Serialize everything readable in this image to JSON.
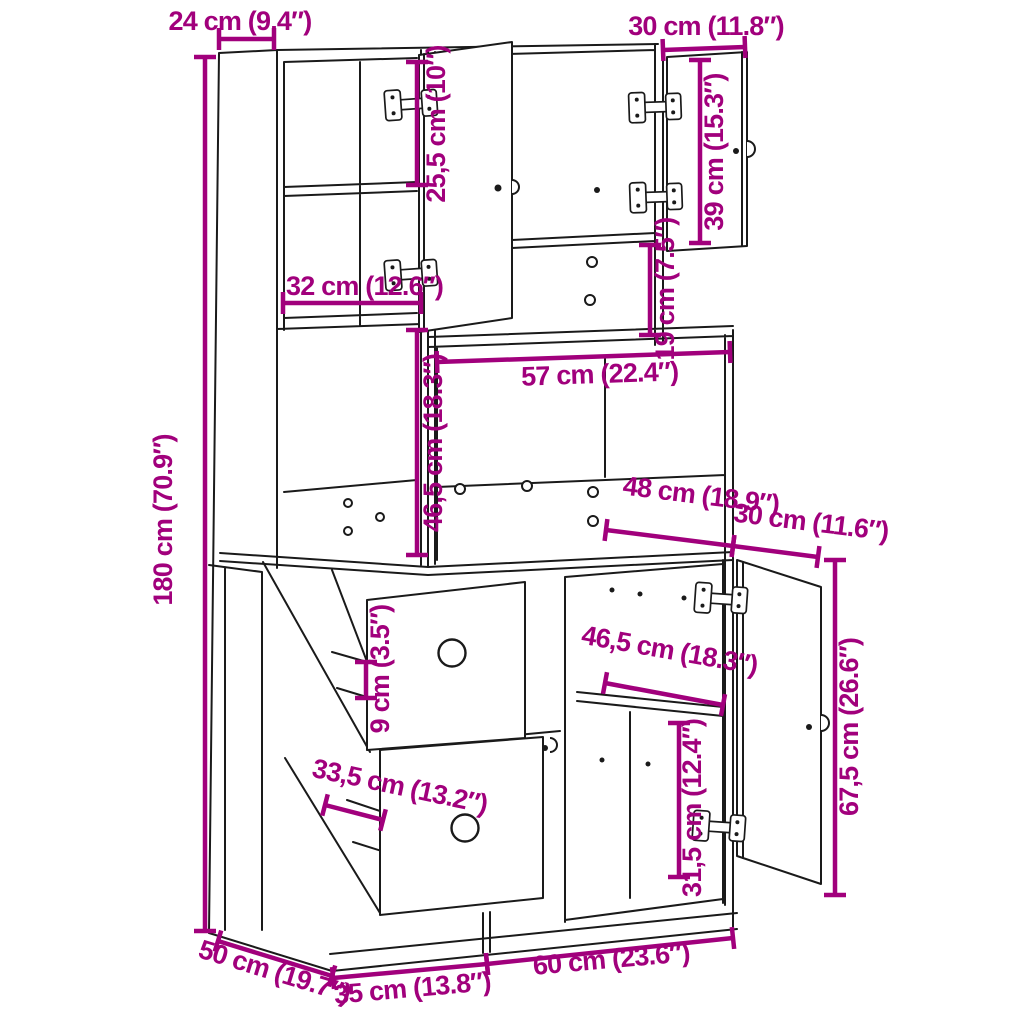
{
  "diagram": {
    "kind": "furniture dimension drawing",
    "subject": "kitchen cabinet with open doors, hinges and shelves"
  },
  "colors": {
    "dimension_accent": "#A1007C",
    "outline": "#1A1A1A",
    "background": "#FFFFFF"
  },
  "dimensions": [
    {
      "id": "width_top_side",
      "label": "24 cm (9.4″)"
    },
    {
      "id": "width_top_right_door",
      "label": "30 cm (11.8″)"
    },
    {
      "id": "height_top_compartment",
      "label": "25,5 cm (10″)"
    },
    {
      "id": "height_right_door",
      "label": "39 cm (15.3″)"
    },
    {
      "id": "width_shelf",
      "label": "32 cm (12.6″)"
    },
    {
      "id": "height_niche_small",
      "label": "19 cm (7.5″)"
    },
    {
      "id": "width_niche",
      "label": "57 cm (22.4″)"
    },
    {
      "id": "height_tall_open",
      "label": "46,5 cm (18.3″)"
    },
    {
      "id": "height_total",
      "label": "180 cm (70.9″)"
    },
    {
      "id": "width_base_interior",
      "label": "48 cm (18.9″)"
    },
    {
      "id": "depth_base_door",
      "label": "30 cm (11.6″)"
    },
    {
      "id": "width_base_right",
      "label": "46,5 cm (18.3″)"
    },
    {
      "id": "height_gap",
      "label": "9 cm (3.5″)"
    },
    {
      "id": "height_base_door",
      "label": "67,5 cm (26.6″)"
    },
    {
      "id": "width_left_door",
      "label": "33,5 cm (13.2″)"
    },
    {
      "id": "height_base_shelf",
      "label": "31,5 cm (12.4″)"
    },
    {
      "id": "depth_total",
      "label": "50 cm (19.7″)"
    },
    {
      "id": "width_base_left",
      "label": "35 cm (13.8″)"
    },
    {
      "id": "width_base_right_bottom",
      "label": "60 cm (23.6″)"
    }
  ]
}
